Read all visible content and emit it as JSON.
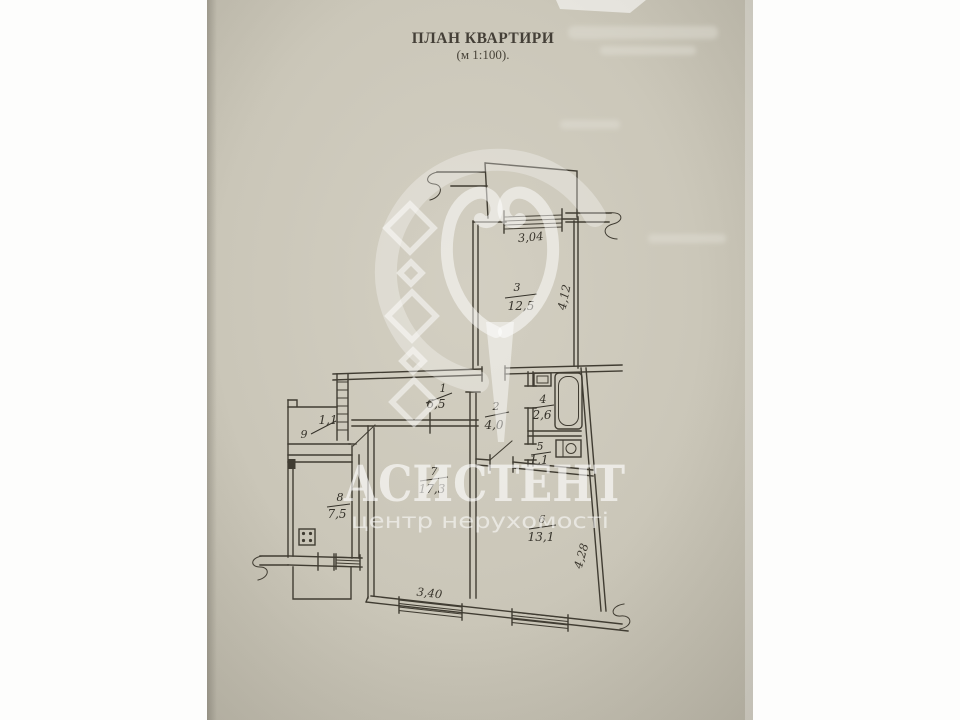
{
  "page": {
    "title1": "ПЛАН КВАРТИРИ",
    "title2": "(м 1:100)."
  },
  "watermark": {
    "brand": "АСИСТЕНТ",
    "tagline": "центр нерухомості"
  },
  "plan": {
    "rooms": {
      "hall1": {
        "number": "1",
        "area": "6,5"
      },
      "hall2": {
        "number": "2",
        "area": "4,0"
      },
      "bedroom3": {
        "number": "3",
        "area": "12,5"
      },
      "bath4": {
        "number": "4",
        "area": "2,6"
      },
      "wc5": {
        "number": "5",
        "area": "1,1"
      },
      "room6": {
        "number": "6",
        "area": "13,1"
      },
      "living7": {
        "number": "7",
        "area": "17,3"
      },
      "kitchen8": {
        "number": "8",
        "area": "7,5"
      },
      "closet9": {
        "number": "9",
        "area": "1,1"
      }
    },
    "dims": {
      "top_window": "3,04",
      "right_upper": "4,12",
      "right_lower": "4,28",
      "bottom": "3,40"
    }
  }
}
